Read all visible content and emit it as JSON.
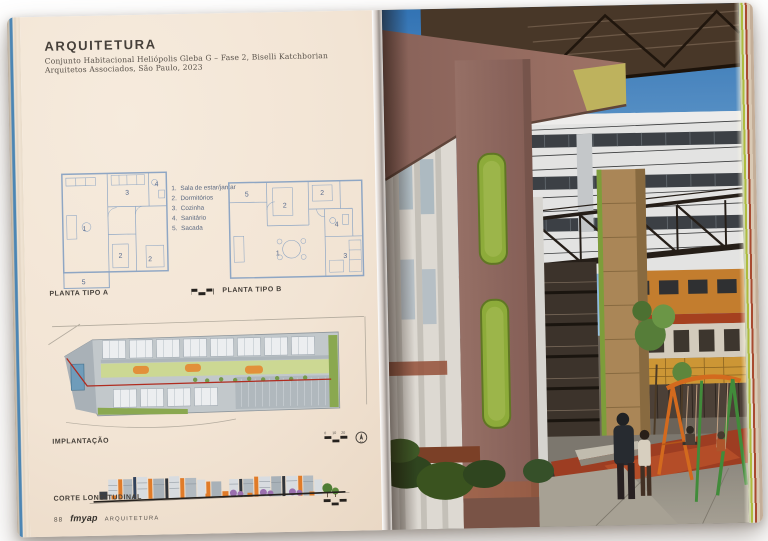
{
  "book": {
    "left_page": {
      "header": {
        "title": "ARQUITETURA",
        "subtitle": "Conjunto Habitacional Heliópolis Gleba G – Fase 2, Biselli Katchborian Arquitetos Associados, São Paulo, 2023"
      },
      "legend": {
        "items": [
          {
            "num": "1.",
            "label": "Sala de estar/jantar"
          },
          {
            "num": "2.",
            "label": "Dormitórios"
          },
          {
            "num": "3.",
            "label": "Cozinha"
          },
          {
            "num": "4.",
            "label": "Sanitário"
          },
          {
            "num": "5.",
            "label": "Sacada"
          }
        ]
      },
      "plans": {
        "plan_a": {
          "label": "PLANTA TIPO A",
          "rooms": [
            "1",
            "3",
            "4",
            "2",
            "2",
            "5"
          ]
        },
        "plan_b": {
          "label": "PLANTA TIPO B",
          "rooms": [
            "5",
            "2",
            "2",
            "4",
            "1",
            "3"
          ]
        }
      },
      "site_plan": {
        "label": "IMPLANTAÇÃO",
        "scale_0": "0",
        "scale_10": "10",
        "scale_20": "20",
        "north": "N"
      },
      "section": {
        "label": "CORTE LONGITUDINAL"
      },
      "footer": {
        "page_number": "88",
        "logo": "fmyap",
        "imprint": "ARQUITETURA"
      }
    },
    "colors": {
      "page_cream": "#f2e4d4",
      "plan_line_blue": "#8ea6c4",
      "site_red_line": "#b02c20",
      "accent_orange": "#e07b28",
      "accent_green": "#8fb03c",
      "sky_blue": "#3f86c8",
      "column_mauve": "#8f6a60",
      "swing_orange": "#d96c1e",
      "swing_green": "#3f8f3c"
    }
  }
}
